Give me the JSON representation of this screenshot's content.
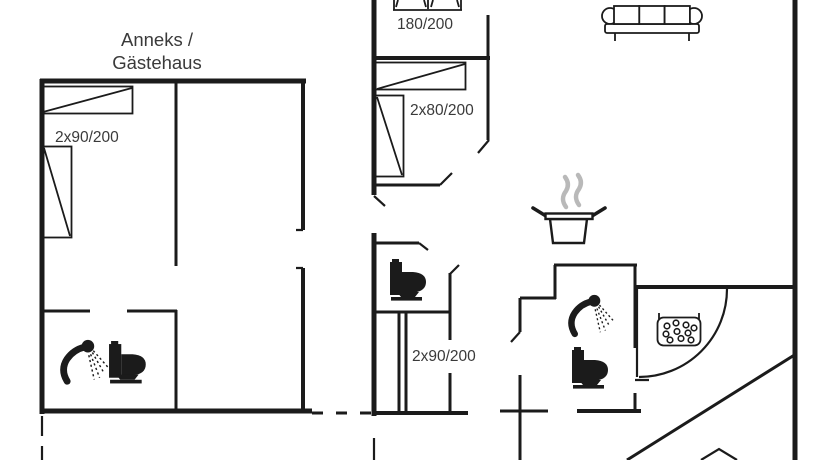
{
  "document": {
    "type": "floor-plan",
    "building_title_line1": "Anneks /",
    "building_title_line2": "Gästehaus"
  },
  "labels": {
    "annex_twin_beds": "2x90/200",
    "double_bed": "180/200",
    "twin_beds": "2x80/200",
    "middle_twin_beds": "2x90/200"
  },
  "icons": [
    "shower-icon",
    "toilet-icon",
    "cooking-pot-icon",
    "steam-icon",
    "sofa-icon",
    "sauna-stones-icon",
    "door-swing-arc",
    "bed-symbol"
  ],
  "colors": {
    "wall": "#1b1b1b",
    "label_text": "#3a3a3a",
    "steam": "#b9b9b9",
    "background": "#ffffff"
  }
}
